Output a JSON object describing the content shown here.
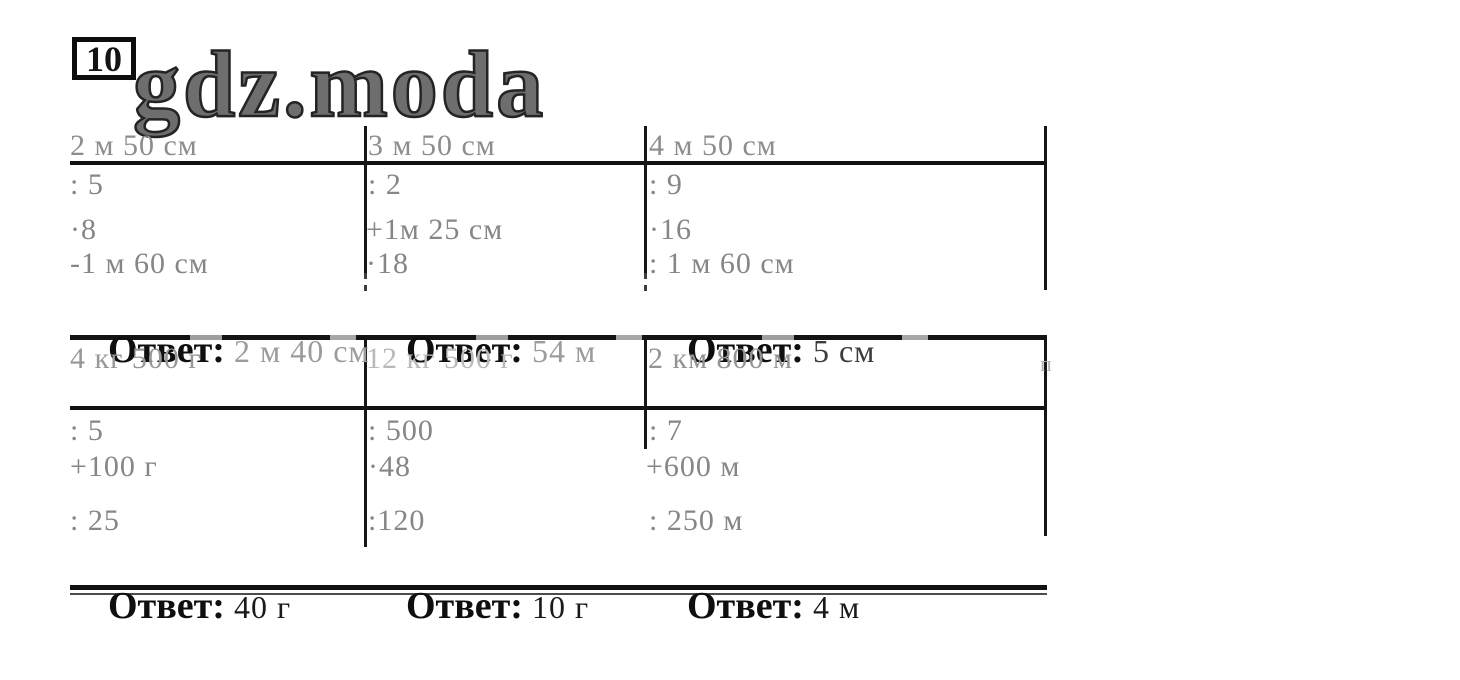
{
  "badge": {
    "number": "10"
  },
  "logo": {
    "text": "gdz.moda"
  },
  "worksheet": {
    "answer_label": "Ответ:",
    "rows": [
      {
        "cells": [
          {
            "start": "2 м 50 см",
            "steps": [
              ": 5",
              "·8",
              "-1 м 60 см"
            ],
            "answer": "2 м 40 см"
          },
          {
            "start": "3 м 50 см",
            "steps": [
              ": 2",
              "+1м 25 см",
              "·18"
            ],
            "answer": "54 м"
          },
          {
            "start": "4 м 50 см",
            "steps": [
              ": 9",
              "·16",
              ": 1 м 60 см"
            ],
            "answer": "5 см"
          }
        ]
      },
      {
        "cells": [
          {
            "start": "4 кг 500 г",
            "steps": [
              ": 5",
              "+100 г",
              ": 25"
            ],
            "answer": "40 г"
          },
          {
            "start": "12 кг 500 г",
            "steps": [
              ": 500",
              "·48",
              ":120"
            ],
            "answer": "10 г"
          },
          {
            "start": "2 км 800 м",
            "steps": [
              ": 7",
              "+600 м",
              ": 250 м"
            ],
            "answer": "4 м"
          }
        ]
      }
    ],
    "scan_artifact": "п"
  },
  "colors": {
    "grid_line": "#111111",
    "problem_text_gray": "#868686",
    "header_faded": "#b9b9b9",
    "answer_label_black": "#0f0f0f",
    "answer_value_gray": "#9c9c9c",
    "answer_value_black": "#1a1a1a"
  }
}
